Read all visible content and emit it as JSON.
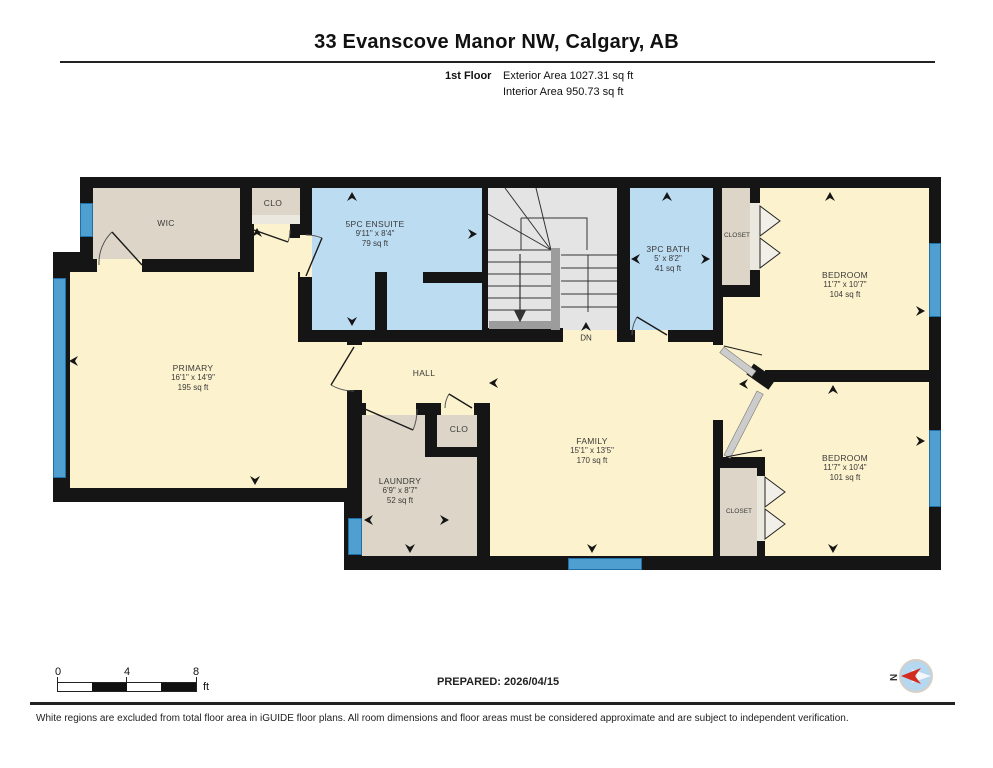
{
  "header": {
    "title": "33 Evanscove Manor NW, Calgary, AB",
    "floor_label": "1st Floor",
    "exterior_area": "Exterior Area 1027.31 sq ft",
    "interior_area": "Interior Area 950.73 sq ft"
  },
  "rooms": [
    {
      "name": "WIC"
    },
    {
      "name": "CLO"
    },
    {
      "name": "5PC ENSUITE",
      "dim": "9'11\" x 8'4\"",
      "area": "79 sq ft"
    },
    {
      "name": "3PC BATH",
      "dim": "5' x 8'2\"",
      "area": "41 sq ft"
    },
    {
      "name": "CLOSET"
    },
    {
      "name": "BEDROOM",
      "dim": "11'7\" x 10'7\"",
      "area": "104 sq ft"
    },
    {
      "name": "PRIMARY",
      "dim": "16'1\" x 14'9\"",
      "area": "195 sq ft"
    },
    {
      "name": "HALL"
    },
    {
      "name": "CLO"
    },
    {
      "name": "FAMILY",
      "dim": "15'1\" x 13'5\"",
      "area": "170 sq ft"
    },
    {
      "name": "LAUNDRY",
      "dim": "6'9\" x 8'7\"",
      "area": "52 sq ft"
    },
    {
      "name": "CLOSET"
    },
    {
      "name": "BEDROOM",
      "dim": "11'7\" x 10'4\"",
      "area": "101 sq ft"
    }
  ],
  "stairs": {
    "down_label": "DN"
  },
  "scale_bar": {
    "tick0": "0",
    "tick4": "4",
    "tick8": "8",
    "unit": "ft"
  },
  "footer": {
    "prepared": "PREPARED: 2026/04/15",
    "compass_north": "N",
    "disclaimer": "White regions are excluded from total floor area in iGUIDE floor plans. All room dimensions and floor areas must be considered approximate and are subject to independent verification."
  },
  "colors": {
    "wall": "#151515",
    "cream": "#fcf2cd",
    "tan": "#ddd6c8",
    "tanlight": "#ebe8df",
    "blue": "#bcdcf2",
    "stair": "#e4e4e4",
    "stairrail": "#9c9c9c",
    "window": "#4f9fd0",
    "windowdark": "#1f6ea6",
    "door": "#cccccc",
    "compassbg": "#b5d7ef",
    "accent": "#d42b1e"
  }
}
